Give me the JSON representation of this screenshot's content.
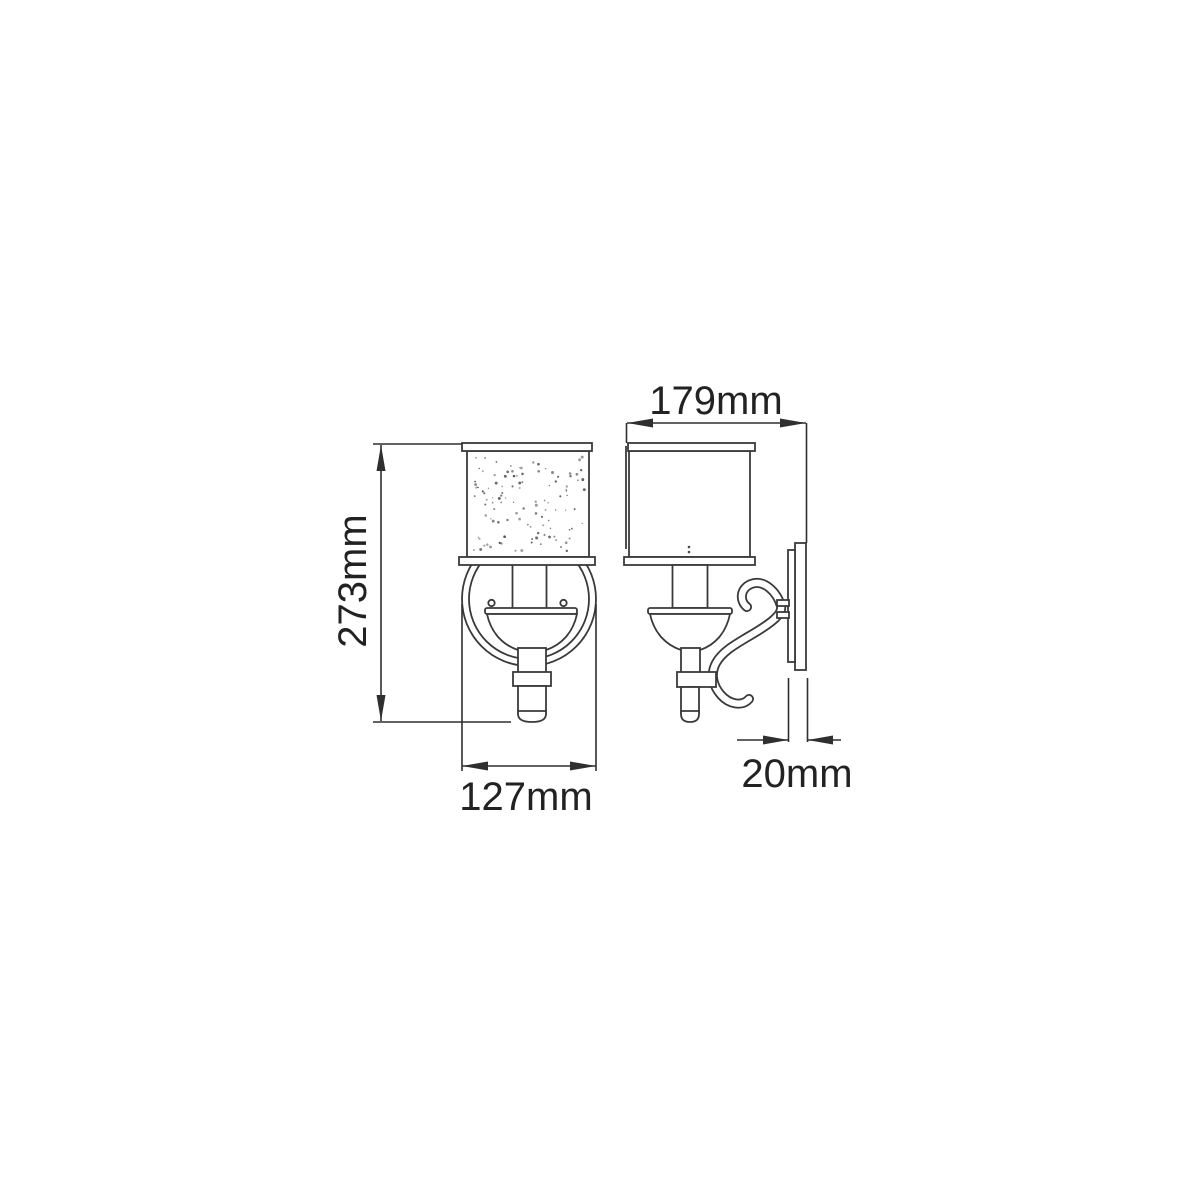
{
  "page": {
    "background_color": "#ffffff",
    "line_color": "#3a3a3a",
    "text_color": "#222222"
  },
  "diagram": {
    "type": "technical-dimension-drawing",
    "subject": "wall sconce light fixture with cylindrical seeded-glass shade, candle stem, ring frame and scroll arm",
    "views": [
      {
        "id": "front",
        "name": "front elevation"
      },
      {
        "id": "side",
        "name": "side elevation"
      }
    ],
    "shade_texture": "seeded-glass dots",
    "dimensions": {
      "height": {
        "label": "273mm",
        "value_mm": 273,
        "view": "front"
      },
      "width": {
        "label": "127mm",
        "value_mm": 127,
        "view": "front"
      },
      "projection": {
        "label": "179mm",
        "value_mm": 179,
        "view": "side"
      },
      "backplate": {
        "label": "20mm",
        "value_mm": 20,
        "view": "side"
      }
    }
  }
}
